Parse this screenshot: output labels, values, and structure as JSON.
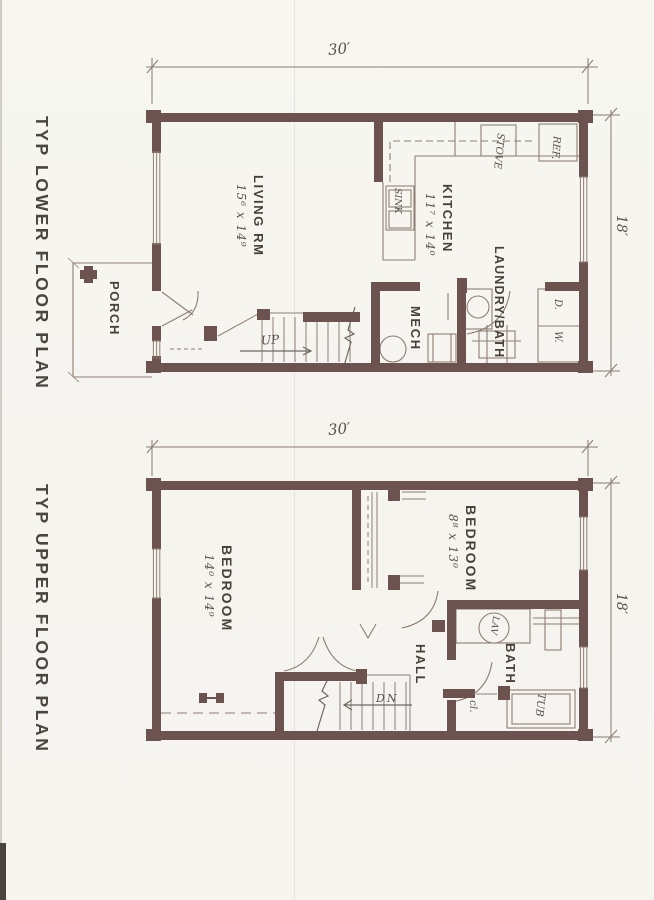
{
  "titles": {
    "lower": "TYP LOWER FLOOR PLAN",
    "upper": "TYP UPPER FLOOR PLAN"
  },
  "colors": {
    "wall": "#6d534f",
    "thin_line": "#8f7e74",
    "hand_line": "#6f675f",
    "label_text": "#474139",
    "background": "#f6f5f0"
  },
  "lower": {
    "dim_width": "30′",
    "dim_height": "18′",
    "living": {
      "label": "LIVING RM",
      "dims": "15⁶ x 14⁹"
    },
    "kitchen": {
      "label": "KITCHEN",
      "dims": "11⁷ x 14⁰"
    },
    "porch": {
      "label": "PORCH"
    },
    "mech": {
      "label": "MECH"
    },
    "laundry_bath": {
      "label": "LAUNDRY/BATH"
    },
    "fixtures": {
      "sink": "SINK",
      "stove": "STOVE",
      "fridge": "REF.",
      "dryer": "D.",
      "washer": "W."
    },
    "stair_label": "UP"
  },
  "upper": {
    "dim_width": "30′",
    "dim_height": "18′",
    "bedroom1": {
      "label": "BEDROOM",
      "dims": "14⁰ x 14⁹"
    },
    "bedroom2": {
      "label": "BEDROOM",
      "dims": "8⁸ x 13⁰"
    },
    "hall": {
      "label": "HALL"
    },
    "bath": {
      "label": "BATH"
    },
    "closet": {
      "label": "cl."
    },
    "fixtures": {
      "lav": "LAV",
      "tub": "TUB"
    },
    "stair_label": "DN"
  }
}
